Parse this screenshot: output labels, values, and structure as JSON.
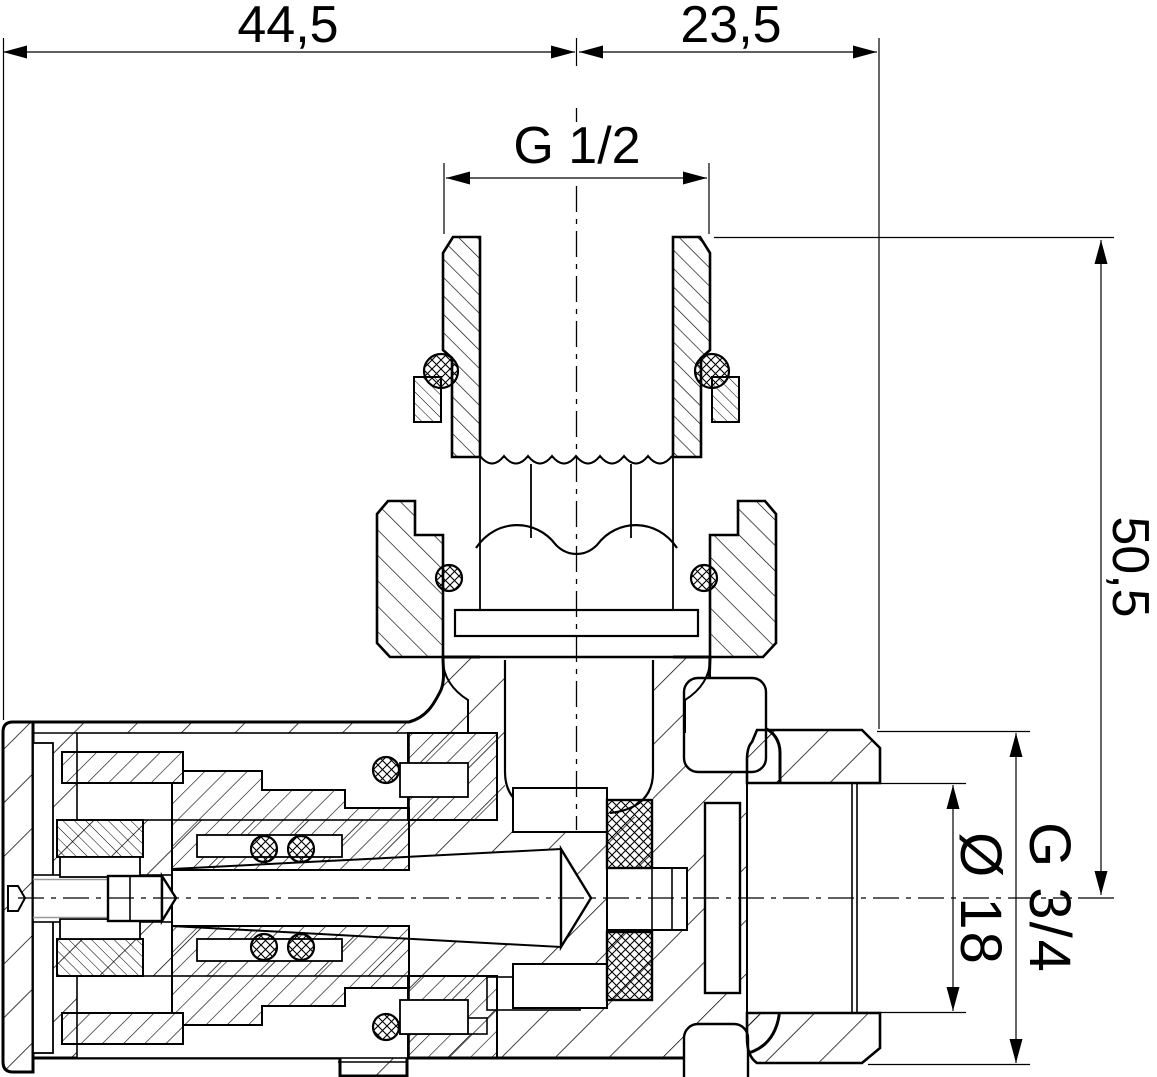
{
  "drawing": {
    "type": "engineering cross-section drawing",
    "subject": "angle valve with male G 1/2 tailpiece, union nut and female G 3/4 outlet",
    "background_color": "#ffffff",
    "line_color": "#000000",
    "aux_line_color": "#9a9a9a"
  },
  "dimensions": {
    "width_left": {
      "label": "44,5",
      "orientation": "horizontal"
    },
    "width_right": {
      "label": "23,5",
      "orientation": "horizontal"
    },
    "thread_top": {
      "label": "G 1/2",
      "orientation": "horizontal"
    },
    "height_right": {
      "label": "50,5",
      "orientation": "vertical"
    },
    "bore": {
      "label": "Ø 18",
      "orientation": "vertical"
    },
    "thread_right": {
      "label": "G 3/4",
      "orientation": "vertical"
    }
  }
}
